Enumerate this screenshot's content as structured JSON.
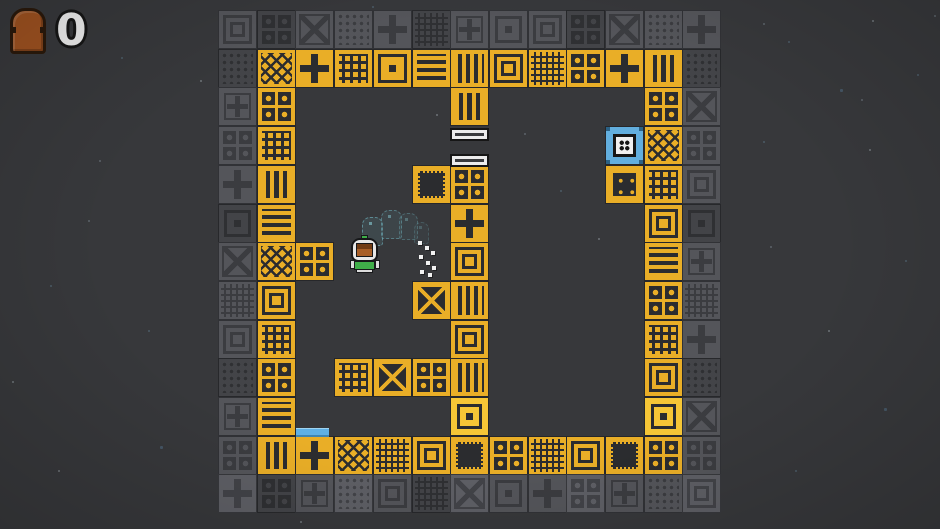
{
  "hud": {
    "door_count": "0"
  },
  "colors": {
    "vars": {
      "--bg": "#37383b",
      "--yl": "#e9ae27",
      "--yl2": "#f6c636",
      "--dk": "#2b2c2f",
      "--gb": "#54555a",
      "--gd2": "#3b3c40",
      "--bl": "#62aede",
      "--wh": "#ececec"
    },
    "door_brown": "#9d5120",
    "player_green": "#3fae49",
    "platform_blue": "#5fb0e5"
  },
  "board": {
    "origin_x": 218,
    "origin_y": 10,
    "pitch": 38.7,
    "cols": 13,
    "rows": 13,
    "map": [
      "GGGGGGGGGGGGG",
      "GWWWWWWWWWCWG",
      "GW....W....WG",
      "GW....=...BWG",
      "GW...DO...SWG",
      "GW....W....WG",
      "GWO...W....WG",
      "GW...XW....WG",
      "GW....W....WG",
      "GW.WWWW....WG",
      "GW....A....AG",
      "GWWWWWWWWWWWG",
      "GGGGGGGGGGGGG"
    ],
    "legend": {
      "G": "border-tile",
      "W": "wall-tile",
      "A": "anchor-tile",
      "O": "circles-tile",
      "D": "dotted-tile",
      "S": "socket-tile",
      "X": "x-tile",
      "C": "cross-tile",
      "B": "blue-switch-tile",
      ".": "empty",
      "=": "gate-bars"
    }
  },
  "objects": {
    "gate_bars": [
      {
        "x": 450,
        "y": 128,
        "w": 39,
        "h": 13
      },
      {
        "x": 450,
        "y": 154,
        "w": 39,
        "h": 13
      }
    ],
    "blue_platform": {
      "x": 296,
      "y": 428,
      "w": 33,
      "h": 9
    },
    "player": {
      "x": 350,
      "y": 235,
      "w": 30,
      "h": 38
    },
    "ghosts": [
      {
        "x": 362,
        "y": 217,
        "w": 21,
        "h": 29,
        "o": 0.85
      },
      {
        "x": 381,
        "y": 210,
        "w": 21,
        "h": 29,
        "o": 0.7
      },
      {
        "x": 399,
        "y": 213,
        "w": 19,
        "h": 27,
        "o": 0.5
      },
      {
        "x": 414,
        "y": 222,
        "w": 15,
        "h": 22,
        "o": 0.35
      }
    ],
    "particles": [
      [
        418,
        241
      ],
      [
        425,
        246
      ],
      [
        431,
        251
      ],
      [
        419,
        255
      ],
      [
        426,
        261
      ],
      [
        432,
        266
      ],
      [
        420,
        270
      ],
      [
        428,
        273
      ]
    ]
  },
  "stars": [
    [
      34,
      12
    ],
    [
      121,
      57
    ],
    [
      200,
      80
    ],
    [
      99,
      160
    ],
    [
      50,
      285
    ],
    [
      12,
      381
    ],
    [
      160,
      446
    ],
    [
      372,
      6
    ],
    [
      436,
      114
    ],
    [
      524,
      133
    ],
    [
      560,
      190
    ],
    [
      598,
      238
    ],
    [
      652,
      398
    ],
    [
      630,
      483
    ],
    [
      300,
      521
    ],
    [
      763,
      23
    ],
    [
      788,
      41
    ],
    [
      872,
      20
    ],
    [
      934,
      15
    ],
    [
      917,
      74
    ],
    [
      840,
      89
    ],
    [
      861,
      99
    ],
    [
      763,
      141
    ],
    [
      869,
      149
    ],
    [
      770,
      246
    ],
    [
      905,
      260
    ],
    [
      828,
      330
    ],
    [
      884,
      408
    ],
    [
      795,
      470
    ],
    [
      58,
      470
    ],
    [
      88,
      220
    ],
    [
      148,
      330
    ]
  ]
}
